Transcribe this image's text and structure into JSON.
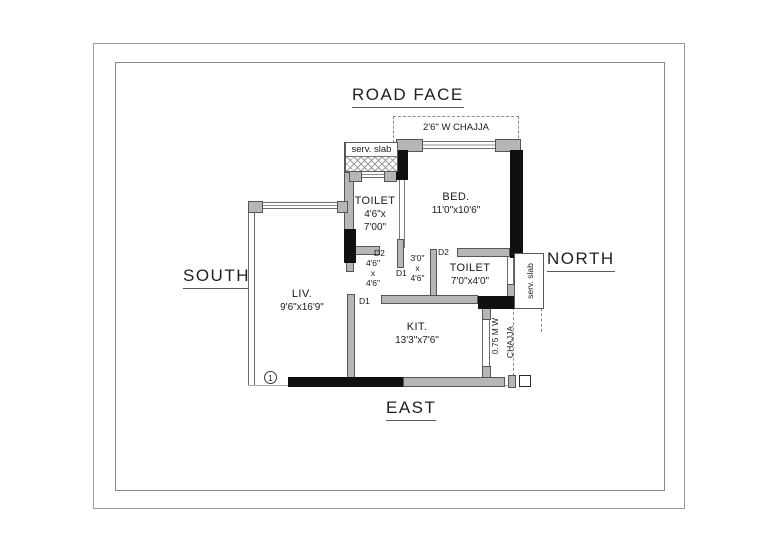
{
  "compass": {
    "top": "ROAD FACE",
    "left": "SOUTH",
    "right": "NORTH",
    "bottom": "EAST"
  },
  "rooms": {
    "toilet1": {
      "name": "TOILET",
      "dim1": "4'6\"x",
      "dim2": "7'00\""
    },
    "bed": {
      "name": "BED.",
      "dims": "11'0\"x10'6\""
    },
    "toilet2": {
      "name": "TOILET",
      "dims": "7'0\"x4'0\""
    },
    "living": {
      "name": "LIV.",
      "dims": "9'6\"x16'9\""
    },
    "kitchen": {
      "name": "KIT.",
      "dims": "13'3\"x7'6\""
    }
  },
  "passages": {
    "p1": {
      "w": "4'6\"",
      "x": "x",
      "h": "4'6\""
    },
    "p2": {
      "w": "3'0\"",
      "x": "x",
      "h": "4'6\""
    }
  },
  "doors": {
    "d1": "D1",
    "d2": "D2"
  },
  "annotations": {
    "chajja_top": "2'6\" W CHAJJA",
    "chajja_side1": "0.75 M W",
    "chajja_side2": "CHAJJA",
    "serv_slab": "serv. slab",
    "marker1": "1"
  },
  "colors": {
    "wall_black": "#101010",
    "wall_gray": "#b6b6b6",
    "text": "#1b1b1b"
  }
}
